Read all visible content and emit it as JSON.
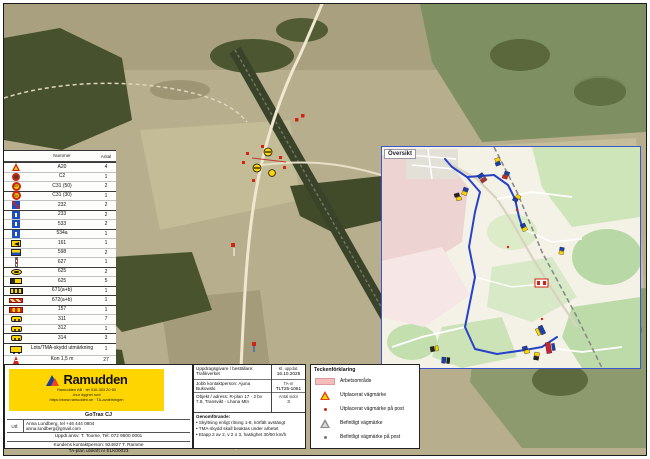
{
  "colors": {
    "brand_yellow": "#ffd500",
    "route_blue": "#2742c8",
    "workzone_pink": "#f5bcbc",
    "warning_red": "#cf2413"
  },
  "inset": {
    "label": "Översikt"
  },
  "sign_table": {
    "headers": {
      "name": "Nummer",
      "count": "Antal"
    },
    "rows": [
      {
        "icon": "warning-triangle-icon",
        "name": "A20",
        "count": "4",
        "sep": true
      },
      {
        "icon": "prohibition-circle-icon",
        "name": "C2",
        "count": "1"
      },
      {
        "icon": "speed-50-icon",
        "name": "C31 (50)",
        "count": "2"
      },
      {
        "icon": "speed-30-icon",
        "name": "C31 (30)",
        "count": "1",
        "sep": true
      },
      {
        "icon": "blue-red-sign-icon",
        "name": "232",
        "count": "2"
      },
      {
        "icon": "blue-sign-icon",
        "name": "233",
        "count": "2",
        "sep": true
      },
      {
        "icon": "blue-sign-icon",
        "name": "533",
        "count": "2"
      },
      {
        "icon": "blue-sign-icon",
        "name": "534a",
        "count": "1",
        "sep": true
      },
      {
        "icon": "yellow-arrow-sign-icon",
        "name": "161",
        "count": "1"
      },
      {
        "icon": "yellow-blue-sign-icon",
        "name": "598",
        "count": "2"
      },
      {
        "icon": "delineator-post-icon",
        "name": "627",
        "count": "1"
      },
      {
        "icon": "yellow-oval-sign-icon",
        "name": "625",
        "count": "2",
        "sep": true
      },
      {
        "icon": "traffic-screen-icon",
        "name": "625",
        "count": "5"
      },
      {
        "icon": "striped-screen-icon",
        "name": "671(a+b)",
        "count": "1",
        "sep": true
      },
      {
        "icon": "barrier-icon",
        "name": "672(a+b)",
        "count": "1",
        "sep": true
      },
      {
        "icon": "red-striped-barrier-icon",
        "name": "157",
        "count": "1",
        "sep": true
      },
      {
        "icon": "warning-lamp-icon",
        "name": "311",
        "count": "7"
      },
      {
        "icon": "warning-lamp-icon",
        "name": "312",
        "count": "1"
      },
      {
        "icon": "warning-lamp-icon",
        "name": "314",
        "count": "3",
        "sep": true
      },
      {
        "icon": "sign-trailer-icon",
        "name": "Lots/TMA-skydd utmärkning",
        "count": "1",
        "sep": true,
        "tall": true
      },
      {
        "icon": "cone-icon",
        "name": "Kon 1,5 m",
        "count": "27"
      },
      {
        "icon": "marker-flag-icon",
        "name": "Markör",
        "count": "1"
      },
      {
        "icon": "worker-icon",
        "name": "Personal",
        "count": "3"
      }
    ]
  },
  "legend": {
    "title": "Teckenförklaring",
    "items": [
      {
        "icon": "workzone-swatch",
        "label": "Arbetsområde"
      },
      {
        "icon": "new-sign-triangle-icon",
        "label": "Utplacerat vägmärke"
      },
      {
        "icon": "new-sign-post-icon",
        "label": "Utplacerat vägmärke på post"
      },
      {
        "icon": "existing-sign-triangle-icon",
        "label": "Befintligt vägmärke"
      },
      {
        "icon": "existing-sign-post-icon",
        "label": "Befintligt vägmärke på post"
      }
    ]
  },
  "info_block": {
    "left_rows": [
      "Uppdragsgivare / beställare: Trafikverket",
      "Jobb kontaktperson: Ajuna Bukowski",
      "Objekt / adress: R-plan 17 - 2 bv 7.8, Transvikt - Lhana Mtn"
    ],
    "meta": [
      {
        "label": "Kl. uppdat.",
        "value": "16.10.2025"
      },
      {
        "label": "TA-nr",
        "value": "TLT25-1051"
      },
      {
        "label": "Antal sidor",
        "value": "3"
      }
    ],
    "notes_title": "Genomförande:",
    "notes": [
      "Skyltning enligt ritning 1-8, körfält avstängt",
      "TMA-skydd skall beaktas under arbetet",
      "Etapp 2 av 2, v 2 o 3, hastighet 30/50 km/h"
    ]
  },
  "company_block": {
    "logo_word": "Ramudden",
    "logo_lines": [
      "Ramudden AB · tel 010-303 20 60",
      "Jour dygnet runt",
      "https://www.ramudden.se · TA-avdelningen"
    ],
    "contractor": "GoTrax CJ",
    "contact_label": "Utf.",
    "contact_lines": [
      "Anna Lundberg, tel +46 444 0804",
      "anna.lundberg@gmail.com"
    ],
    "manager_line": "Uppdr.ansv: T. Toome, Tel: 072 9500 0001",
    "customer_line": "Kundens kontaktperson: 924927 T. Ramme",
    "print_line": "TA-plan utskrift nr ELK00023"
  }
}
